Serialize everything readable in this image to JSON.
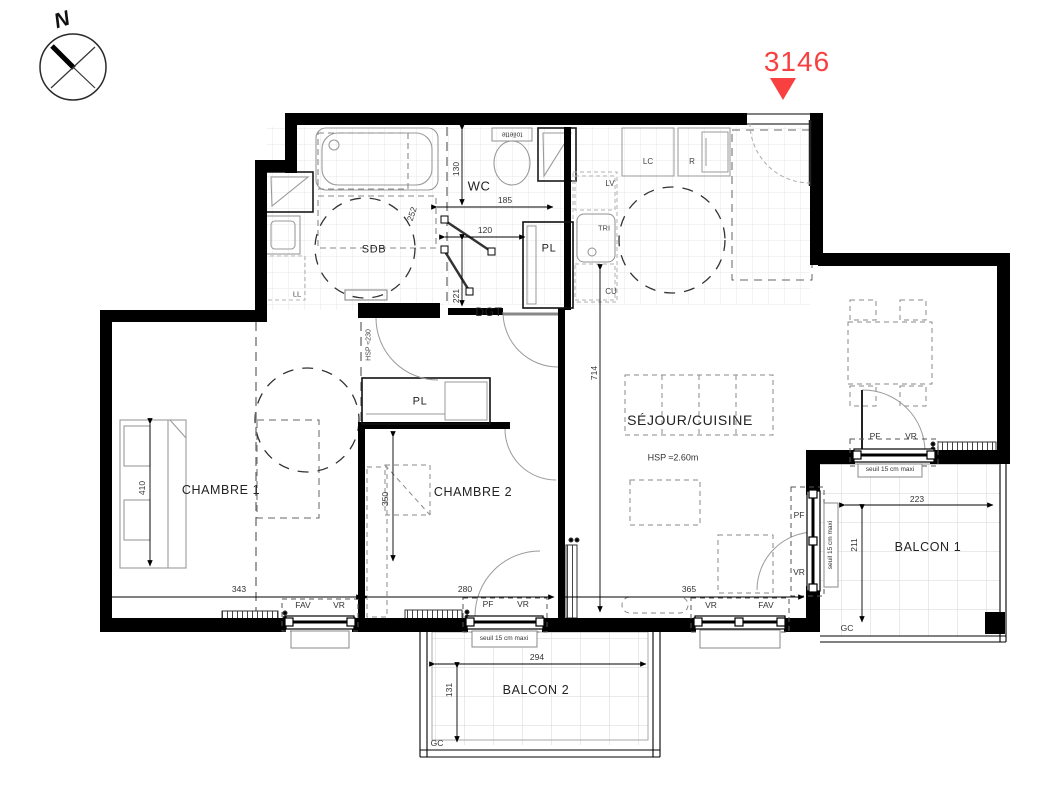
{
  "lot": {
    "number": "3146"
  },
  "compass": {
    "north": "N"
  },
  "colors": {
    "accent_red": "#f84040",
    "wall_black": "#000000"
  },
  "rooms": {
    "sdb": "SDB",
    "wc": "WC",
    "dgt": "DGT",
    "pl_hall": "PL",
    "pl_bedroom": "PL",
    "chambre1": "CHAMBRE 1",
    "chambre2": "CHAMBRE 2",
    "sejour": "SÉJOUR/CUISINE",
    "balcon1": "BALCON 1",
    "balcon2": "BALCON 2"
  },
  "notes": {
    "hsp_sejour": "HSP ≈2.60m",
    "hsp_dgt": "HSP ≈230",
    "toilette": "toilette",
    "seuil_chambre2": "seuil 15 cm maxi",
    "seuil_balcon1_top": "seuil 15 cm maxi",
    "seuil_balcon1_side": "seuil 15 cm maxi"
  },
  "appliances": {
    "ll": "LL",
    "lv": "LV",
    "tri": "TRI",
    "cu": "CU",
    "lc": "LC",
    "r": "R",
    "gc_balcon1": "GC",
    "gc_balcon2": "GC"
  },
  "window_labels": {
    "chambre1_left": "FAV",
    "chambre1_right": "VR",
    "chambre2_left": "PF",
    "chambre2_right": "VR",
    "sejour_left": "VR",
    "sejour_right": "FAV",
    "dining_left": "PF",
    "dining_right": "VR",
    "side_top": "PF",
    "side_bottom": "VR"
  },
  "dimensions": {
    "wc_height": "130",
    "wc_width": "185",
    "wc_door": "120",
    "wc_lower": "221",
    "sdb_door": "252",
    "sejour_depth": "714",
    "chambre1_depth": "410",
    "chambre1_width": "343",
    "chambre2_depth": "350",
    "chambre2_width": "280",
    "sejour_width": "365",
    "balcon2_width": "294",
    "balcon2_depth": "131",
    "balcon1_width": "223",
    "balcon1_depth": "211"
  }
}
